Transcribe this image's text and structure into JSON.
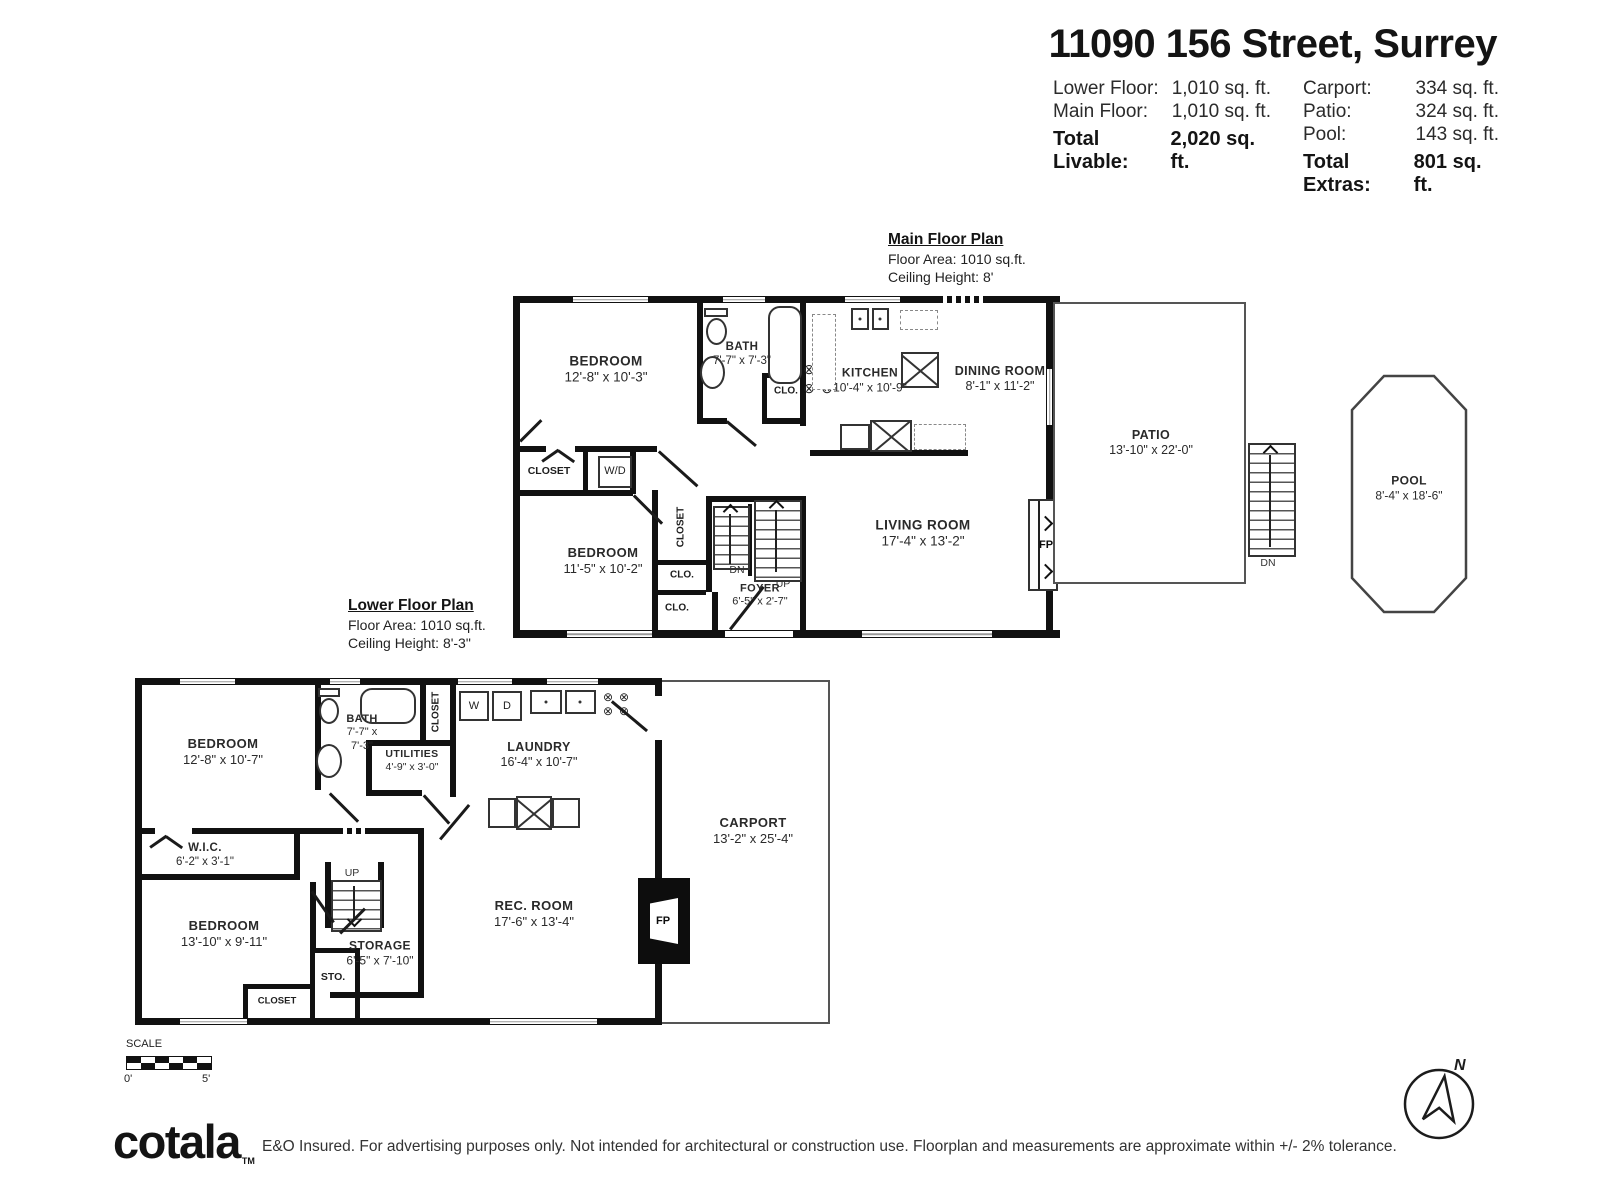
{
  "header": {
    "title": "11090 156 Street, Surrey",
    "left_rows": [
      {
        "label": "Lower Floor:",
        "value": "1,010 sq. ft."
      },
      {
        "label": "Main Floor:",
        "value": "1,010 sq. ft."
      }
    ],
    "left_total": {
      "label": "Total Livable:",
      "value": "2,020 sq. ft."
    },
    "right_rows": [
      {
        "label": "Carport:",
        "value": "334 sq. ft."
      },
      {
        "label": "Patio:",
        "value": "324 sq. ft."
      },
      {
        "label": "Pool:",
        "value": "143 sq. ft."
      }
    ],
    "right_total": {
      "label": "Total Extras:",
      "value": "801 sq. ft."
    }
  },
  "main_floor": {
    "heading": "Main Floor Plan",
    "area": "Floor Area: 1010 sq.ft.",
    "ceiling": "Ceiling Height: 8'",
    "rooms": {
      "bedroom1": {
        "name": "BEDROOM",
        "dims": "12'-8\" x 10'-3\""
      },
      "bath": {
        "name": "BATH",
        "dims": "7'-7\" x 7'-3\""
      },
      "kitchen": {
        "name": "KITCHEN",
        "dims": "10'-4\" x 10'-9\""
      },
      "dining": {
        "name": "DINING ROOM",
        "dims": "8'-1\" x 11'-2\""
      },
      "living": {
        "name": "LIVING ROOM",
        "dims": "17'-4\" x 13'-2\""
      },
      "bedroom2": {
        "name": "BEDROOM",
        "dims": "11'-5\" x 10'-2\""
      },
      "foyer": {
        "name": "FOYER",
        "dims": "6'-5\" x 2'-7\""
      },
      "patio": {
        "name": "PATIO",
        "dims": "13'-10\" x 22'-0\""
      },
      "pool": {
        "name": "POOL",
        "dims": "8'-4\" x 18'-6\""
      }
    },
    "labels": {
      "closet_wd": "CLOSET",
      "wd": "W/D",
      "closet_vert": "CLOSET",
      "clo_bath": "CLO.",
      "clo_1": "CLO.",
      "clo_2": "CLO.",
      "dn": "DN",
      "up": "UP",
      "fp": "FP",
      "patio_dn": "DN"
    }
  },
  "lower_floor": {
    "heading": "Lower Floor Plan",
    "area": "Floor Area: 1010 sq.ft.",
    "ceiling": "Ceiling Height: 8'-3\"",
    "rooms": {
      "bedroom1": {
        "name": "BEDROOM",
        "dims": "12'-8\" x 10'-7\""
      },
      "bath": {
        "name": "BATH",
        "dims_line1": "7'-7\" x",
        "dims_line2": "7'-3\""
      },
      "utilities": {
        "name": "UTILITIES",
        "dims": "4'-9\" x 3'-0\""
      },
      "laundry": {
        "name": "LAUNDRY",
        "dims": "16'-4\" x 10'-7\""
      },
      "wic": {
        "name": "W.I.C.",
        "dims": "6'-2\" x 3'-1\""
      },
      "bedroom2": {
        "name": "BEDROOM",
        "dims": "13'-10\" x 9'-11\""
      },
      "storage": {
        "name": "STORAGE",
        "dims": "6'-5\" x 7'-10\""
      },
      "rec_room": {
        "name": "REC. ROOM",
        "dims": "17'-6\" x 13'-4\""
      },
      "carport": {
        "name": "CARPORT",
        "dims": "13'-2\" x 25'-4\""
      }
    },
    "labels": {
      "closet_vert": "CLOSET",
      "w": "W",
      "d": "D",
      "up": "UP",
      "sto": "STO.",
      "closet": "CLOSET",
      "fp": "FP"
    }
  },
  "footer": {
    "scale_label": "SCALE",
    "scale_zero": "0'",
    "scale_five": "5'",
    "logo": "cotala",
    "logo_tm": "TM",
    "disclaimer": "E&O Insured. For advertising purposes only. Not intended for architectural or construction use. Floorplan and measurements are approximate within +/- 2% tolerance.",
    "compass_n": "N"
  },
  "icons": {
    "stove_burner": "⊗"
  },
  "colors": {
    "wall": "#111111",
    "thin_line": "#555555",
    "text": "#262626"
  }
}
